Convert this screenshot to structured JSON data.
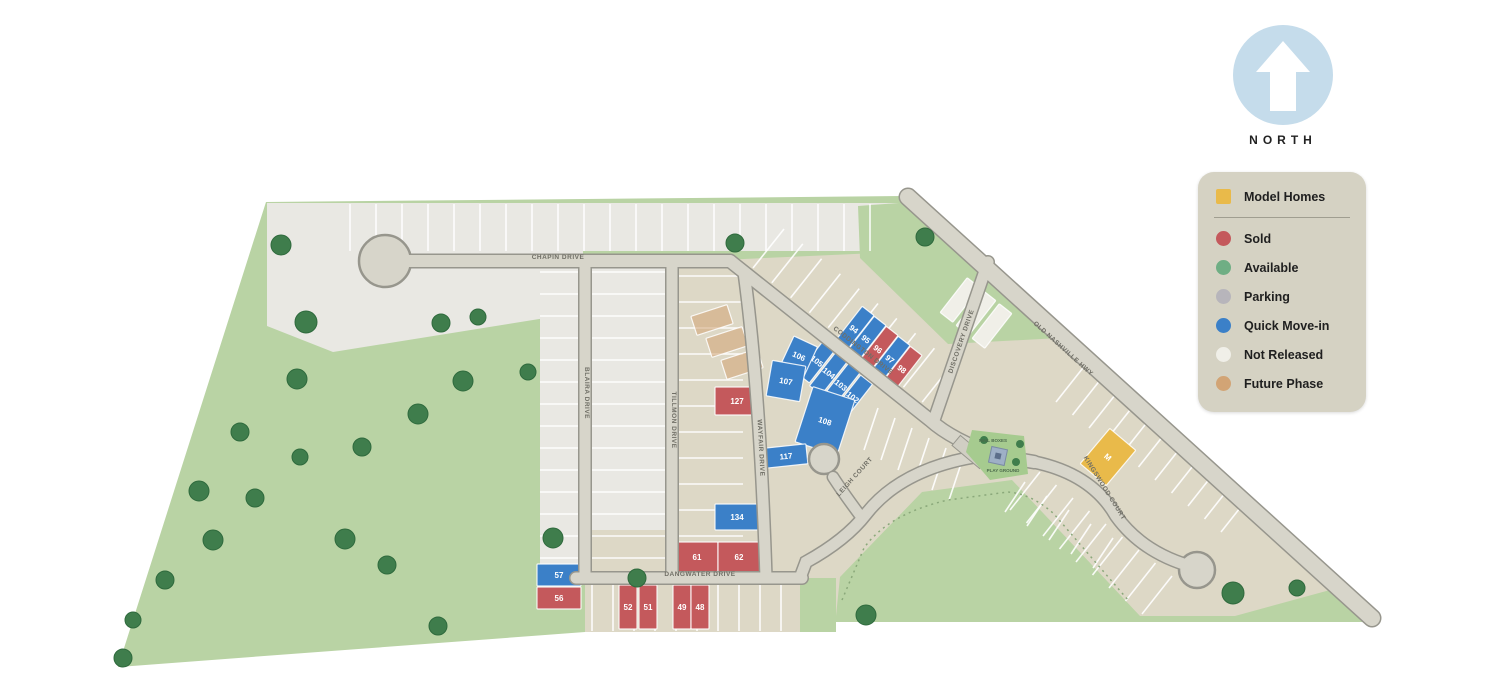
{
  "north": {
    "label": "NORTH"
  },
  "legend": {
    "items": [
      {
        "id": "model-homes",
        "label": "Model Homes",
        "color": "#e9ba4a",
        "shape": "square"
      },
      {
        "id": "sold",
        "label": "Sold",
        "color": "#c4595c",
        "shape": "circle"
      },
      {
        "id": "available",
        "label": "Available",
        "color": "#6fae84",
        "shape": "circle"
      },
      {
        "id": "parking",
        "label": "Parking",
        "color": "#b7b5bb",
        "shape": "circle"
      },
      {
        "id": "quick-move-in",
        "label": "Quick Move-in",
        "color": "#3b80c8",
        "shape": "circle"
      },
      {
        "id": "not-released",
        "label": "Not Released",
        "color": "#f0efe8",
        "shape": "circle"
      },
      {
        "id": "future-phase",
        "label": "Future Phase",
        "color": "#d2a475",
        "shape": "circle"
      }
    ]
  },
  "colors": {
    "green_area": "#b9d3a4",
    "tree": "#3f7d4c",
    "park_green": "#a6cb8f",
    "road_fill": "#d7d5ca",
    "road_casing": "#97968d",
    "lot_beige": "#ddd8c6",
    "lot_gray": "#e9e8e3",
    "north_circle": "#c5dceb",
    "legend_bg": "#d5d2c3"
  },
  "map": {
    "streets": [
      {
        "name": "CHAPIN DRIVE",
        "x": 558,
        "y": 259,
        "rot": 0
      },
      {
        "name": "BLAIRA DRIVE",
        "x": 585,
        "y": 393,
        "rot": 90
      },
      {
        "name": "TILLMON DRIVE",
        "x": 672,
        "y": 420,
        "rot": 90
      },
      {
        "name": "WAYFAIR DRIVE",
        "x": 759,
        "y": 448,
        "rot": 87
      },
      {
        "name": "DANGWATER DRIVE",
        "x": 700,
        "y": 576,
        "rot": 0
      },
      {
        "name": "CODDINGTON DRIVE",
        "x": 862,
        "y": 352,
        "rot": 38
      },
      {
        "name": "DISCOVERY DRIVE",
        "x": 963,
        "y": 342,
        "rot": -71
      },
      {
        "name": "OLD NASHVILLE HWY",
        "x": 1062,
        "y": 350,
        "rot": 42
      },
      {
        "name": "KINGSWOOD COURT",
        "x": 1103,
        "y": 489,
        "rot": 58
      },
      {
        "name": "LEIGH COURT",
        "x": 856,
        "y": 478,
        "rot": -48
      }
    ],
    "lots": [
      {
        "num": "94",
        "status": "quick-move-in",
        "x": 854,
        "y": 329,
        "w": 15,
        "h": 46,
        "rot": 38
      },
      {
        "num": "95",
        "status": "quick-move-in",
        "x": 866,
        "y": 339,
        "w": 15,
        "h": 46,
        "rot": 38
      },
      {
        "num": "96",
        "status": "sold",
        "x": 878,
        "y": 349,
        "w": 15,
        "h": 46,
        "rot": 38
      },
      {
        "num": "97",
        "status": "quick-move-in",
        "x": 890,
        "y": 359,
        "w": 15,
        "h": 46,
        "rot": 38
      },
      {
        "num": "98",
        "status": "sold",
        "x": 902,
        "y": 369,
        "w": 15,
        "h": 46,
        "rot": 38
      },
      {
        "num": "105",
        "status": "quick-move-in",
        "x": 817,
        "y": 361,
        "w": 15,
        "h": 44,
        "rot": 38
      },
      {
        "num": "104",
        "status": "quick-move-in",
        "x": 829,
        "y": 373,
        "w": 15,
        "h": 44,
        "rot": 38
      },
      {
        "num": "103",
        "status": "quick-move-in",
        "x": 841,
        "y": 385,
        "w": 15,
        "h": 44,
        "rot": 38
      },
      {
        "num": "102",
        "status": "quick-move-in",
        "x": 853,
        "y": 397,
        "w": 15,
        "h": 44,
        "rot": 38
      },
      {
        "num": "106",
        "status": "quick-move-in",
        "x": 799,
        "y": 356,
        "w": 26,
        "h": 32,
        "rot": 25
      },
      {
        "num": "107",
        "status": "quick-move-in",
        "x": 786,
        "y": 381,
        "w": 34,
        "h": 36,
        "rot": 10
      },
      {
        "num": "108",
        "status": "quick-move-in",
        "x": 825,
        "y": 421,
        "w": 44,
        "h": 58,
        "rot": 18
      },
      {
        "num": "117",
        "status": "quick-move-in",
        "x": 786,
        "y": 456,
        "w": 42,
        "h": 20,
        "rot": -6
      },
      {
        "num": "134",
        "status": "quick-move-in",
        "x": 737,
        "y": 517,
        "w": 44,
        "h": 26,
        "rot": 0
      },
      {
        "num": "127",
        "status": "sold",
        "x": 737,
        "y": 401,
        "w": 44,
        "h": 28,
        "rot": 0
      },
      {
        "num": "57",
        "status": "quick-move-in",
        "x": 559,
        "y": 575,
        "w": 44,
        "h": 22,
        "rot": 0
      },
      {
        "num": "56",
        "status": "sold",
        "x": 559,
        "y": 598,
        "w": 44,
        "h": 22,
        "rot": 0
      },
      {
        "num": "61",
        "status": "sold",
        "x": 697,
        "y": 557,
        "w": 42,
        "h": 30,
        "rot": 0
      },
      {
        "num": "62",
        "status": "sold",
        "x": 739,
        "y": 557,
        "w": 42,
        "h": 30,
        "rot": 0
      },
      {
        "num": "52",
        "status": "sold",
        "x": 628,
        "y": 607,
        "w": 18,
        "h": 44,
        "rot": 0
      },
      {
        "num": "51",
        "status": "sold",
        "x": 648,
        "y": 607,
        "w": 18,
        "h": 44,
        "rot": 0
      },
      {
        "num": "49",
        "status": "sold",
        "x": 682,
        "y": 607,
        "w": 18,
        "h": 44,
        "rot": 0
      },
      {
        "num": "48",
        "status": "sold",
        "x": 700,
        "y": 607,
        "w": 18,
        "h": 44,
        "rot": 0
      },
      {
        "num": "M",
        "status": "model-homes",
        "x": 1108,
        "y": 457,
        "w": 34,
        "h": 46,
        "rot": 40
      },
      {
        "num": "",
        "status": "future-phase",
        "x": 712,
        "y": 320,
        "w": 38,
        "h": 20,
        "rot": -18
      },
      {
        "num": "",
        "status": "future-phase",
        "x": 727,
        "y": 342,
        "w": 38,
        "h": 20,
        "rot": -18
      },
      {
        "num": "",
        "status": "future-phase",
        "x": 742,
        "y": 364,
        "w": 38,
        "h": 20,
        "rot": -18
      },
      {
        "num": "",
        "status": "not-released",
        "x": 960,
        "y": 300,
        "w": 16,
        "h": 44,
        "rot": 38
      },
      {
        "num": "",
        "status": "not-released",
        "x": 976,
        "y": 313,
        "w": 16,
        "h": 44,
        "rot": 38
      },
      {
        "num": "",
        "status": "not-released",
        "x": 992,
        "y": 326,
        "w": 16,
        "h": 44,
        "rot": 38
      }
    ],
    "park": {
      "labels": [
        {
          "text": "MAIL BOXES",
          "x": 993,
          "y": 442
        },
        {
          "text": "PLAY GROUND",
          "x": 1003,
          "y": 472
        }
      ]
    }
  }
}
